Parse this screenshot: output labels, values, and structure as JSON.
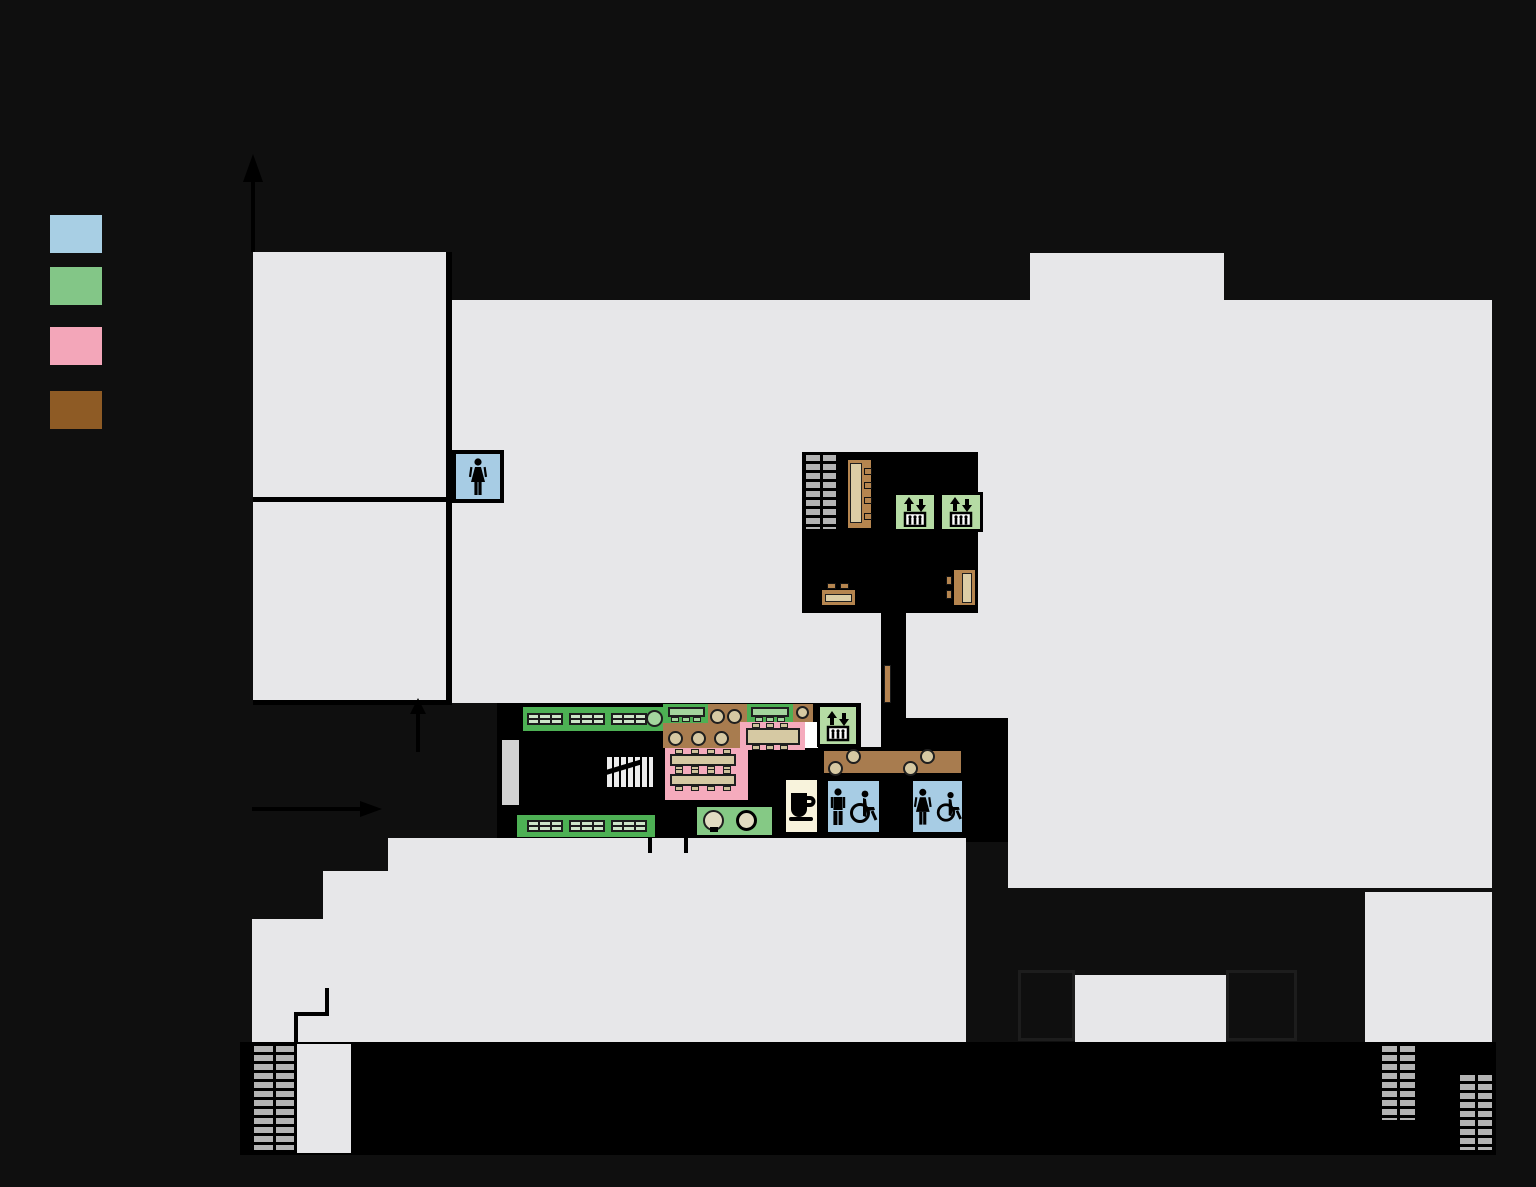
{
  "palette": {
    "background": "#0f0f0f",
    "ink": "#000000",
    "floor": "#e7e7e9",
    "floor-bright": "#ffffff",
    "wall-gray": "#d2d2d2",
    "stairs-tread": "#b3b3b3",
    "legend-blue": "#a8cfe4",
    "legend-green": "#83c687",
    "legend-pink": "#f3a6b9",
    "legend-brown": "#8e5b25",
    "zone-green": "#4db054",
    "elevator-green": "#b5dba4",
    "shelf-cell": "#cde5c8",
    "zone-pink": "#f5abbd",
    "zone-brown": "#a87c4f",
    "table-tan": "#d6c9a3",
    "chair-tan": "#cfc29c",
    "desk-brown": "#b5854f",
    "desk-inner": "#dccda5",
    "cafe-cream": "#f8f3dc",
    "restroom-blue": "#a7cce4",
    "door-brown": "#b58350",
    "table-green": "#a4d69e",
    "square-green": "#85c985"
  },
  "legend": {
    "swatches": [
      {
        "name": "blue",
        "color_key": "legend-blue"
      },
      {
        "name": "green",
        "color_key": "legend-green"
      },
      {
        "name": "pink",
        "color_key": "legend-pink"
      },
      {
        "name": "brown",
        "color_key": "legend-brown"
      }
    ]
  },
  "arrows": {
    "north": "up",
    "entrance_side": "right",
    "entrance_front": "up"
  },
  "facilities": {
    "restrooms": [
      {
        "type": "womens",
        "icons": [
          "woman-icon"
        ]
      },
      {
        "type": "mens-accessible",
        "icons": [
          "man-icon",
          "wheelchair-icon"
        ]
      },
      {
        "type": "womens-accessible",
        "icons": [
          "woman-icon",
          "wheelchair-icon"
        ]
      }
    ],
    "elevators": {
      "count": 3,
      "icon": "elevator-icon"
    },
    "stairwells": {
      "count": 5
    },
    "escalator": {
      "count": 1,
      "icon": "escalator-arrow-icon"
    },
    "cafe": {
      "icon": "coffee-cup-icon"
    },
    "bookshelf_groups": {
      "count": 6
    },
    "reading_tables_pink": {
      "count": 3
    },
    "study_tables_green": {
      "count": 2
    }
  }
}
